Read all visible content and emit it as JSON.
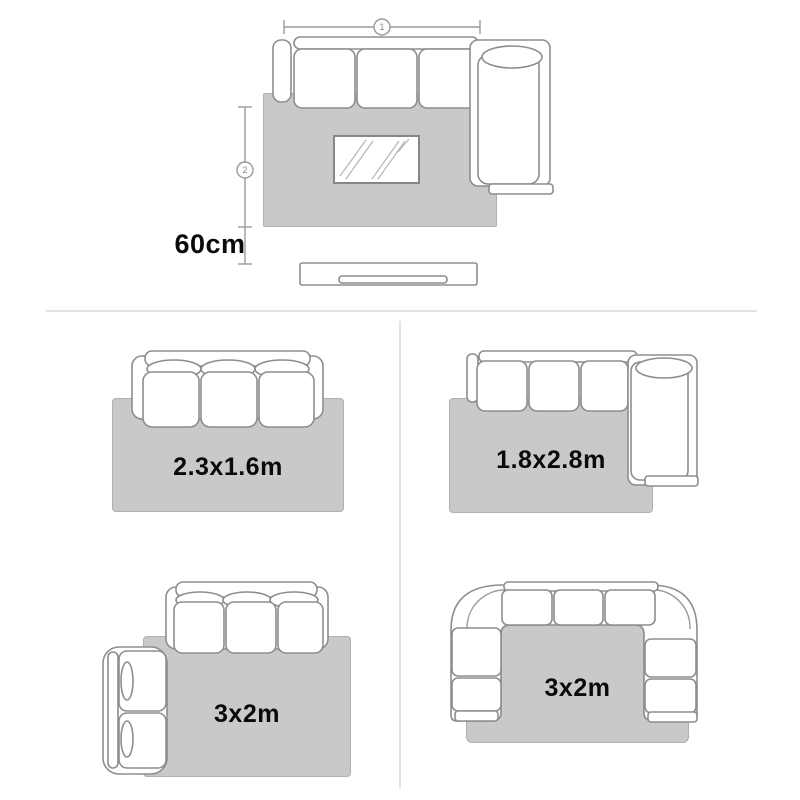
{
  "hero": {
    "width_marker_label": "1",
    "depth_marker_label": "2",
    "clearance_label": "60cm"
  },
  "layouts": [
    {
      "size_label": "2.3x1.6m"
    },
    {
      "size_label": "1.8x2.8m"
    },
    {
      "size_label": "3x2m"
    },
    {
      "size_label": "3x2m"
    }
  ],
  "colors": {
    "rug_fill": "#c9c9c9",
    "rug_border": "#b0b0b0",
    "furniture_outline": "#8d8d8d",
    "dimension_line": "#9a9a9a",
    "divider": "#e3e3e3",
    "label_text": "#0a0a0a"
  }
}
